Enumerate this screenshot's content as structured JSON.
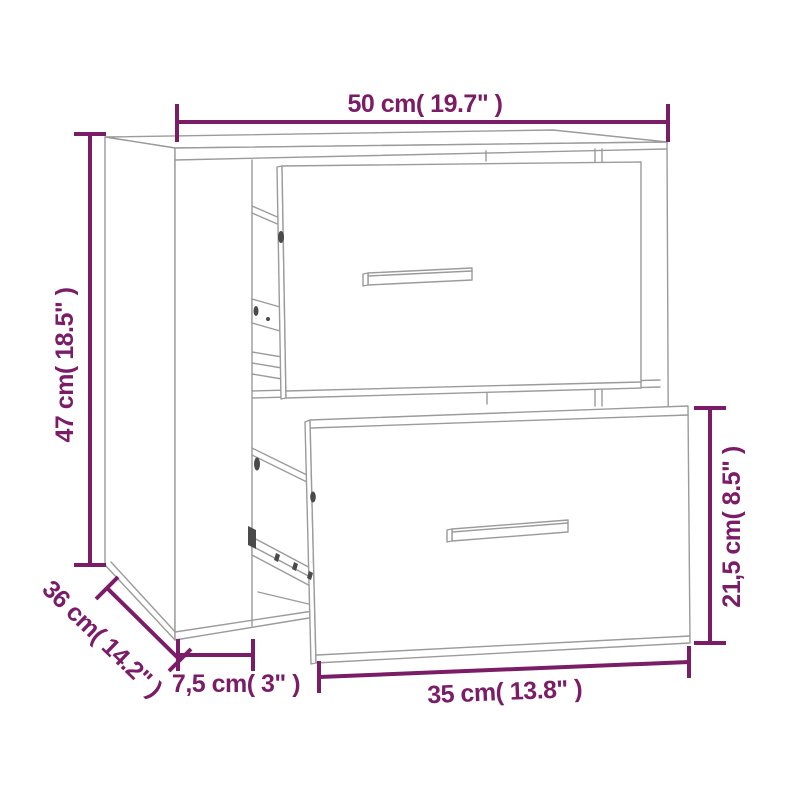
{
  "diagram": {
    "colors": {
      "dimension": "#7a1c66",
      "outline": "#9b9b9b",
      "hardware_dark": "#4a4a4a",
      "background": "#ffffff"
    },
    "cabinet": {
      "type": "wall-mounted bedside cabinet",
      "drawer_count": "2"
    },
    "dimensions": {
      "overall_width": "50 cm( 19.7\" )",
      "overall_height": "47 cm( 18.5\" )",
      "overall_depth": "36 cm( 14.2\" )",
      "side_panel": "7,5 cm( 3\" )",
      "drawer_width": "35 cm( 13.8\" )",
      "drawer_height": "21,5 cm( 8.5\" )"
    }
  }
}
